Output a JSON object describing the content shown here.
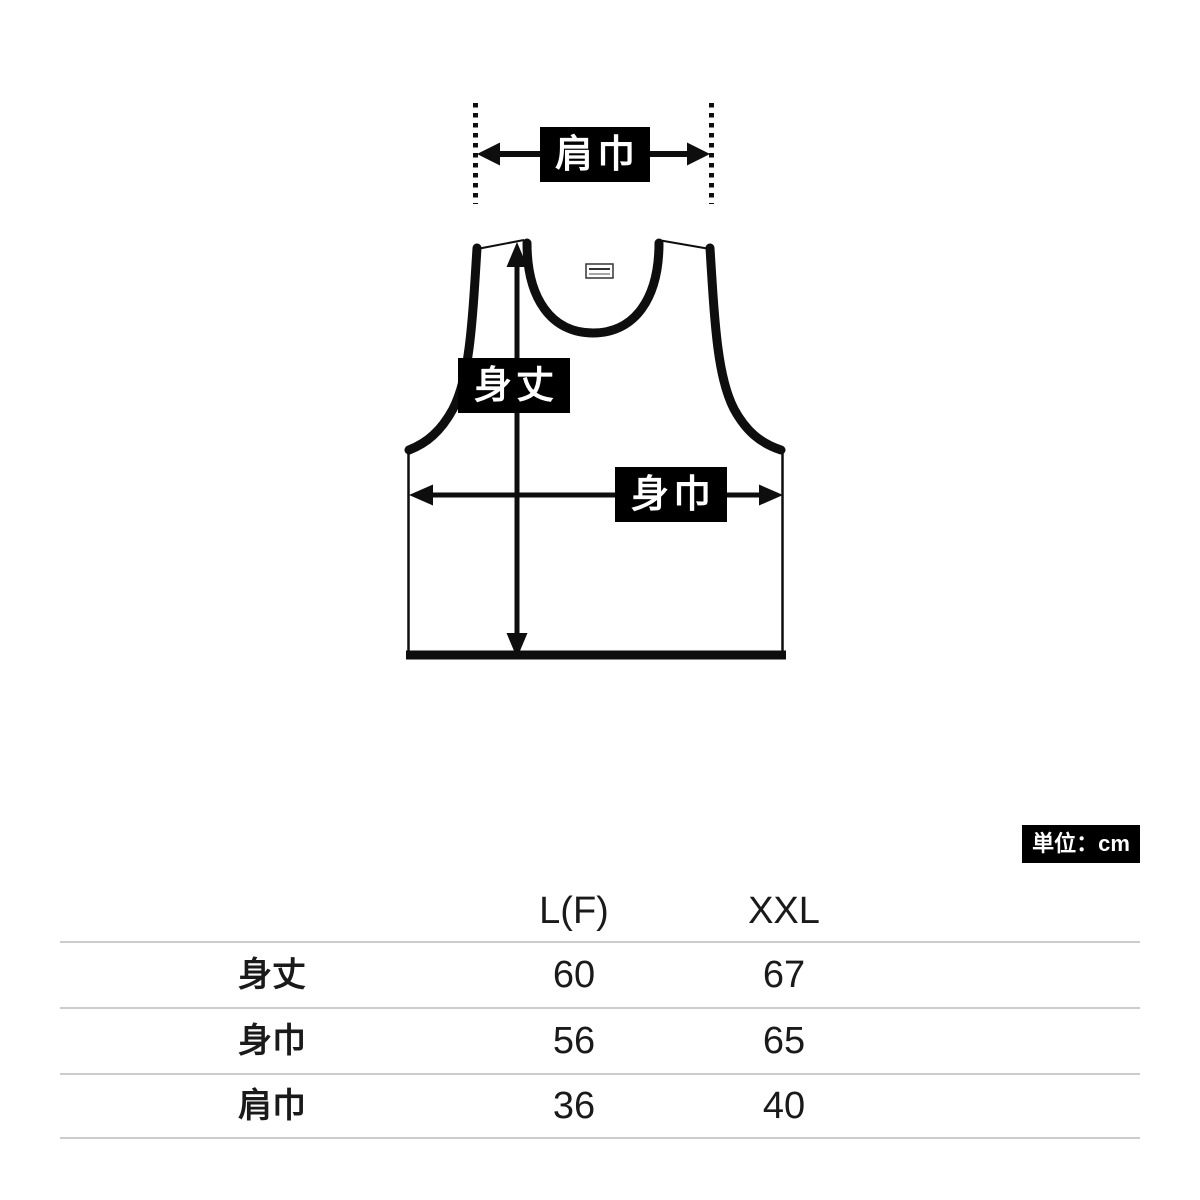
{
  "diagram": {
    "labels": {
      "shoulder_width": "肩巾",
      "body_length": "身丈",
      "body_width": "身巾"
    },
    "unit_label": "単位：cm",
    "colors": {
      "label_bg": "#000000",
      "label_text": "#ffffff",
      "line": "#0e0e0e",
      "table_divider": "#cccccc"
    }
  },
  "size_table": {
    "columns": [
      "L(F)",
      "XXL"
    ],
    "rows": [
      {
        "label": "身丈",
        "values": [
          "60",
          "67"
        ]
      },
      {
        "label": "身巾",
        "values": [
          "56",
          "65"
        ]
      },
      {
        "label": "肩巾",
        "values": [
          "36",
          "40"
        ]
      }
    ]
  },
  "chart_data": {
    "type": "table",
    "unit": "cm",
    "columns": [
      "L(F)",
      "XXL"
    ],
    "rows": [
      {
        "measurement": "身丈",
        "L(F)": 60,
        "XXL": 67
      },
      {
        "measurement": "身巾",
        "L(F)": 56,
        "XXL": 65
      },
      {
        "measurement": "肩巾",
        "L(F)": 36,
        "XXL": 40
      }
    ]
  }
}
